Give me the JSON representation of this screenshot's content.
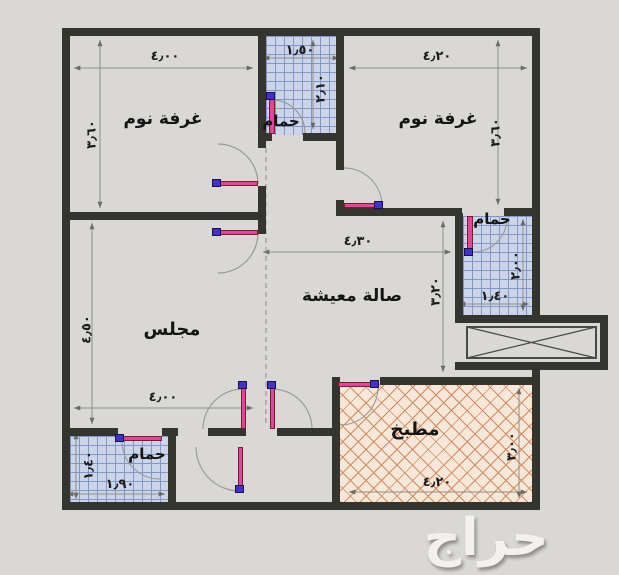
{
  "rooms": {
    "bedroom1": {
      "label": "غرفة نوم",
      "width": "٤٫٠٠",
      "height": "٣٫٦٠"
    },
    "bedroom2": {
      "label": "غرفة نوم",
      "width": "٤٫٢٠",
      "height": "٣٫٦٠"
    },
    "bath_top": {
      "label": "حمام",
      "width": "١٫٥٠",
      "height": "٢٫١٠"
    },
    "bath_right": {
      "label": "حمام",
      "width": "١٫٤٠",
      "height": "٢٫٠٠"
    },
    "bath_bottom_left": {
      "label": "حمام",
      "width": "١٫٩٠",
      "height": "١٫٤٠"
    },
    "majlis": {
      "label": "مجلس",
      "width": "٤٫٠٠",
      "height": "٤٫٥٠"
    },
    "living": {
      "label": "صالة معيشة",
      "width": "٤٫٣٠",
      "height": "٣٫٢٠"
    },
    "kitchen": {
      "label": "مطبخ",
      "width": "٤٫٢٠",
      "height": "٣٫٠٠"
    }
  },
  "watermark": {
    "text": "حراج"
  },
  "colors": {
    "background": "#d9d8d4",
    "wall": "#35352f",
    "bath_tile": "#ccd5e7",
    "bath_grid": "#8296c8",
    "kitchen_tile": "#f6e7d8",
    "kitchen_line": "#d08a5f",
    "door_leaf": "#e0479b",
    "door_knob": "#4431c9",
    "dimension_line": "#8f8f8a",
    "watermark_text": "#f2f1ed"
  }
}
